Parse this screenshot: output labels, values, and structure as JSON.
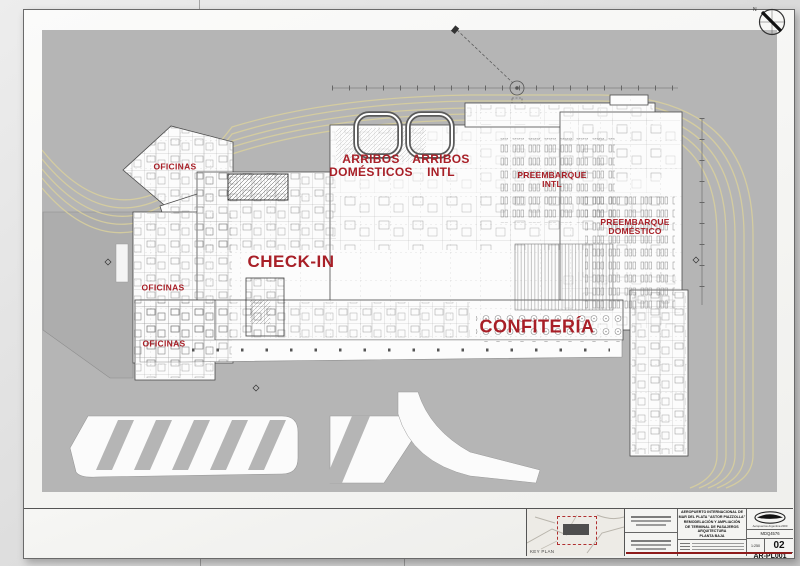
{
  "plan_labels": {
    "oficinas_nw": "OFICINAS",
    "arribos_domesticos": "ARRIBOS\nDOMÉSTICOS",
    "arribos_intl": "ARRIBOS\nINTL",
    "preembarque_intl": "PREEMBARQUE\nINTL",
    "preembarque_domestico": "PREEMBARQUE\nDOMÉSTICO",
    "check_in": "CHECK-IN",
    "oficinas_w": "OFICINAS",
    "oficinas_sw": "OFICINAS",
    "confiteria": "CONFITERÍA"
  },
  "title_block": {
    "key_plan_label": "KEY PLAN",
    "project_title_lines": "AEROPUERTO INTERNACIONAL DE\nMAR DEL PLATA \"ASTOR PIAZZOLLA\"\nREMODELACIÓN Y AMPLIACIÓN\nDE TERMINAL DE PASAJEROS\nARQUITECTURA\nPLANTA BAJA",
    "logo_text": "Aeropuertos Argentina 2000",
    "doc_code": "MDQ4576",
    "scale": "1:250",
    "revision": "02",
    "drawing_number": "AR-PL001"
  },
  "compass": {
    "north_label": "N"
  },
  "colors": {
    "label_red": "#a81f27",
    "site_gray": "#b5b5b5",
    "road_yellow": "#d8cf9e",
    "paper": "#f6f6f4"
  }
}
